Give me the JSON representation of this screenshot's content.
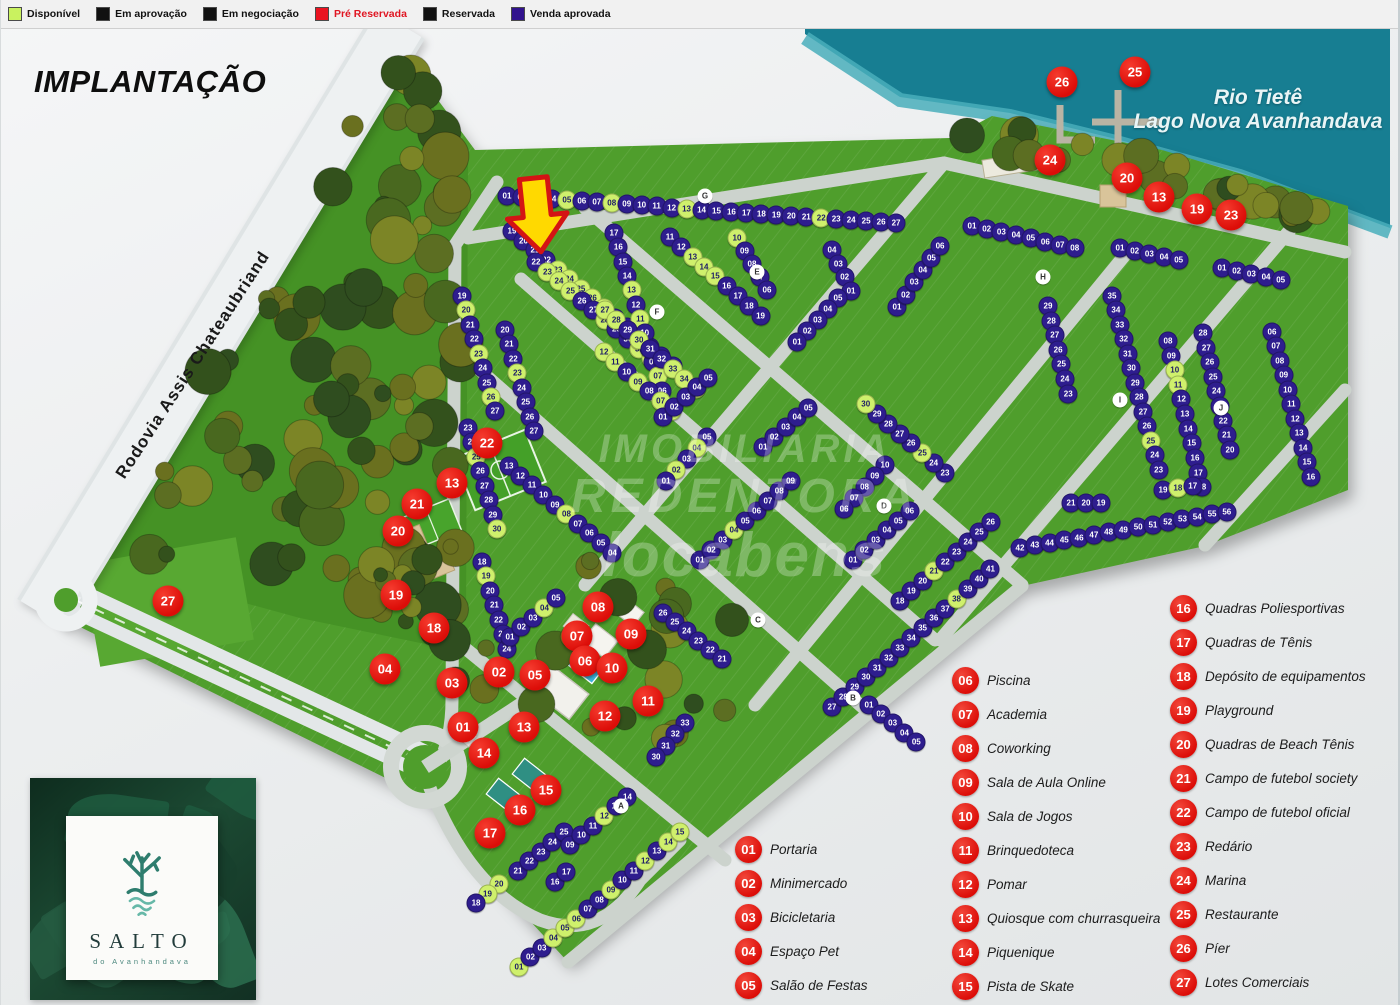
{
  "title": "IMPLANTAÇÃO",
  "road_label": "Rodovia Assis Chateaubriand",
  "water_label": {
    "line1": "Rio Tietê",
    "line2": "Lago Nova Avanhandava"
  },
  "watermark": {
    "line1": "IMOBILIARIA",
    "line2": "REDENTORA",
    "line3": "locabens"
  },
  "logo": {
    "name": "SALTO",
    "subtitle": "do Avanhandava"
  },
  "status_legend": [
    {
      "label": "Disponível",
      "color": "#c9f25f",
      "text": "#111111"
    },
    {
      "label": "Em aprovação",
      "color": "#111111",
      "text": "#111111"
    },
    {
      "label": "Em negociação",
      "color": "#111111",
      "text": "#111111"
    },
    {
      "label": "Pré Reservada",
      "color": "#ea1320",
      "text": "#e01622"
    },
    {
      "label": "Reservada",
      "color": "#111111",
      "text": "#111111"
    },
    {
      "label": "Venda aprovada",
      "color": "#31128d",
      "text": "#111111"
    }
  ],
  "lot_status_colors": {
    "p": {
      "bg": "#2e1d8e",
      "fg": "#ffffff"
    },
    "g": {
      "bg": "#cff06c",
      "fg": "#1d1b66"
    },
    "r": {
      "bg": "#e01313",
      "fg": "#ffffff"
    }
  },
  "amenities": {
    "col1": [
      {
        "num": "01",
        "label": "Portaria"
      },
      {
        "num": "02",
        "label": "Minimercado"
      },
      {
        "num": "03",
        "label": "Bicicletaria"
      },
      {
        "num": "04",
        "label": "Espaço Pet"
      },
      {
        "num": "05",
        "label": "Salão de Festas"
      }
    ],
    "col2": [
      {
        "num": "06",
        "label": "Piscina"
      },
      {
        "num": "07",
        "label": "Academia"
      },
      {
        "num": "08",
        "label": "Coworking"
      },
      {
        "num": "09",
        "label": "Sala de Aula Online"
      },
      {
        "num": "10",
        "label": "Sala de Jogos"
      },
      {
        "num": "11",
        "label": "Brinquedoteca"
      },
      {
        "num": "12",
        "label": "Pomar"
      },
      {
        "num": "13",
        "label": "Quiosque com churrasqueira"
      },
      {
        "num": "14",
        "label": "Piquenique"
      },
      {
        "num": "15",
        "label": "Pista de Skate"
      }
    ],
    "col3": [
      {
        "num": "16",
        "label": "Quadras Poliesportivas"
      },
      {
        "num": "17",
        "label": "Quadras de Tênis"
      },
      {
        "num": "18",
        "label": "Depósito de equipamentos"
      },
      {
        "num": "19",
        "label": "Playground"
      },
      {
        "num": "20",
        "label": "Quadras de Beach Tênis"
      },
      {
        "num": "21",
        "label": "Campo de futebol society"
      },
      {
        "num": "22",
        "label": "Campo de futebol oficial"
      },
      {
        "num": "23",
        "label": "Redário"
      },
      {
        "num": "24",
        "label": "Marina"
      },
      {
        "num": "25",
        "label": "Restaurante"
      },
      {
        "num": "26",
        "label": "Píer"
      },
      {
        "num": "27",
        "label": "Lotes Comerciais"
      }
    ]
  },
  "map_markers": [
    {
      "num": "26",
      "x": 1062,
      "y": 82
    },
    {
      "num": "25",
      "x": 1135,
      "y": 72
    },
    {
      "num": "24",
      "x": 1050,
      "y": 160
    },
    {
      "num": "20",
      "x": 1127,
      "y": 178
    },
    {
      "num": "13",
      "x": 1159,
      "y": 197
    },
    {
      "num": "19",
      "x": 1197,
      "y": 209
    },
    {
      "num": "23",
      "x": 1231,
      "y": 215
    },
    {
      "num": "22",
      "x": 487,
      "y": 443
    },
    {
      "num": "13",
      "x": 452,
      "y": 483
    },
    {
      "num": "21",
      "x": 417,
      "y": 504
    },
    {
      "num": "20",
      "x": 398,
      "y": 531
    },
    {
      "num": "19",
      "x": 396,
      "y": 595
    },
    {
      "num": "18",
      "x": 434,
      "y": 628
    },
    {
      "num": "27",
      "x": 168,
      "y": 601
    },
    {
      "num": "04",
      "x": 385,
      "y": 669
    },
    {
      "num": "03",
      "x": 452,
      "y": 683
    },
    {
      "num": "02",
      "x": 499,
      "y": 672
    },
    {
      "num": "01",
      "x": 463,
      "y": 727
    },
    {
      "num": "08",
      "x": 598,
      "y": 607
    },
    {
      "num": "07",
      "x": 577,
      "y": 636
    },
    {
      "num": "09",
      "x": 631,
      "y": 634
    },
    {
      "num": "06",
      "x": 585,
      "y": 661
    },
    {
      "num": "05",
      "x": 535,
      "y": 675
    },
    {
      "num": "10",
      "x": 612,
      "y": 668
    },
    {
      "num": "11",
      "x": 648,
      "y": 701
    },
    {
      "num": "12",
      "x": 605,
      "y": 716
    },
    {
      "num": "13",
      "x": 524,
      "y": 727
    },
    {
      "num": "14",
      "x": 484,
      "y": 753
    },
    {
      "num": "15",
      "x": 546,
      "y": 790
    },
    {
      "num": "16",
      "x": 520,
      "y": 810
    },
    {
      "num": "17",
      "x": 490,
      "y": 833
    }
  ],
  "block_letters": [
    {
      "l": "A",
      "x": 621,
      "y": 806
    },
    {
      "l": "B",
      "x": 853,
      "y": 698
    },
    {
      "l": "C",
      "x": 758,
      "y": 620
    },
    {
      "l": "D",
      "x": 884,
      "y": 506
    },
    {
      "l": "E",
      "x": 757,
      "y": 272
    },
    {
      "l": "F",
      "x": 657,
      "y": 312
    },
    {
      "l": "G",
      "x": 705,
      "y": 196
    },
    {
      "l": "H",
      "x": 1043,
      "y": 277
    },
    {
      "l": "I",
      "x": 1120,
      "y": 400
    },
    {
      "l": "J",
      "x": 1221,
      "y": 408
    }
  ],
  "lot_rows": [
    {
      "x": 507,
      "y": 196,
      "a": 4,
      "n": 27,
      "s": 1,
      "p": "ppgpgppgppppgppppppppgppppp"
    },
    {
      "x": 512,
      "y": 231,
      "a": 40,
      "n": 15,
      "s": 19,
      "p": "ppppgggggpppppp"
    },
    {
      "x": 462,
      "y": 296,
      "a": 74,
      "n": 9,
      "s": 19,
      "p": "pgppgppgp"
    },
    {
      "x": 536,
      "y": 262,
      "a": 40,
      "n": 12,
      "s": 22,
      "p": "pgggppgppggp"
    },
    {
      "x": 505,
      "y": 330,
      "a": 74,
      "n": 8,
      "s": 20,
      "p": "pppgpppp"
    },
    {
      "x": 614,
      "y": 233,
      "a": 73,
      "n": 12,
      "s": 17,
      "st": -1,
      "p": "ppppgpgpppgp"
    },
    {
      "x": 670,
      "y": 237,
      "a": 41,
      "n": 9,
      "s": 11,
      "p": "ppgggpppp"
    },
    {
      "x": 737,
      "y": 238,
      "a": 60,
      "n": 5,
      "s": 10,
      "st": -1,
      "p": "gpppp"
    },
    {
      "x": 605,
      "y": 310,
      "a": 41,
      "n": 9,
      "s": 27,
      "p": "ggpgppggg"
    },
    {
      "x": 604,
      "y": 352,
      "a": 41,
      "n": 7,
      "s": 12,
      "st": -1,
      "p": "ggpgpgg"
    },
    {
      "x": 663,
      "y": 417,
      "a": -41,
      "n": 5,
      "s": 1,
      "p": "ppppp"
    },
    {
      "x": 468,
      "y": 428,
      "a": 74,
      "n": 8,
      "s": 23,
      "p": "ppgppppg"
    },
    {
      "x": 509,
      "y": 466,
      "a": 40,
      "n": 10,
      "s": 13,
      "st": -1,
      "p": "pppppgpppp"
    },
    {
      "x": 482,
      "y": 562,
      "a": 74,
      "n": 7,
      "s": 18,
      "p": "pgppppp"
    },
    {
      "x": 510,
      "y": 637,
      "a": -40,
      "n": 5,
      "s": 1,
      "p": "pppgp"
    },
    {
      "x": 707,
      "y": 437,
      "a": 133,
      "n": 5,
      "s": 5,
      "st": -1,
      "p": "pgpgp"
    },
    {
      "x": 763,
      "y": 447,
      "a": -41,
      "n": 5,
      "s": 1,
      "p": "ppppp"
    },
    {
      "x": 832,
      "y": 250,
      "a": 65,
      "n": 4,
      "s": 4,
      "st": -1,
      "p": "pppp"
    },
    {
      "x": 838,
      "y": 298,
      "a": 133,
      "n": 5,
      "s": 5,
      "st": -1,
      "p": "ppppp"
    },
    {
      "x": 897,
      "y": 307,
      "a": -55,
      "n": 6,
      "s": 1,
      "p": "pppppp"
    },
    {
      "x": 945,
      "y": 473,
      "a": -139,
      "n": 8,
      "s": 23,
      "p": "ppgppppg"
    },
    {
      "x": 885,
      "y": 465,
      "a": 133,
      "n": 5,
      "s": 10,
      "st": -1,
      "p": "ppppp"
    },
    {
      "x": 853,
      "y": 560,
      "a": -41,
      "n": 6,
      "s": 1,
      "p": "pppppp"
    },
    {
      "x": 700,
      "y": 560,
      "a": -41,
      "n": 9,
      "s": 1,
      "p": "pppgppppp"
    },
    {
      "x": 972,
      "y": 226,
      "a": 12,
      "n": 8,
      "s": 1,
      "p": "pppppppp"
    },
    {
      "x": 1120,
      "y": 248,
      "a": 12,
      "n": 5,
      "s": 1,
      "p": "ppppp"
    },
    {
      "x": 1222,
      "y": 268,
      "a": 12,
      "n": 5,
      "s": 1,
      "p": "ppppp"
    },
    {
      "x": 1112,
      "y": 296,
      "a": 75,
      "n": 13,
      "s": 35,
      "st": -1,
      "p": "ppppppppppgpp"
    },
    {
      "x": 1071,
      "y": 503,
      "a": 0,
      "n": 3,
      "s": 21,
      "st": -1,
      "p": "ppp"
    },
    {
      "x": 1168,
      "y": 341,
      "a": 77,
      "n": 11,
      "s": 8,
      "p": "ppggppppppp"
    },
    {
      "x": 1163,
      "y": 490,
      "a": -8,
      "n": 3,
      "s": 19,
      "st": -1,
      "p": "pgp"
    },
    {
      "x": 1203,
      "y": 333,
      "a": 77,
      "n": 9,
      "s": 28,
      "st": -1,
      "p": "ppppppppp"
    },
    {
      "x": 1272,
      "y": 332,
      "a": 75,
      "n": 11,
      "s": 6,
      "p": "ppppppppppp"
    },
    {
      "x": 1048,
      "y": 306,
      "a": 77,
      "n": 7,
      "s": 29,
      "st": -1,
      "p": "ppppppp"
    },
    {
      "x": 832,
      "y": 707,
      "a": -41,
      "n": 15,
      "s": 27,
      "p": "pppppppppppgppp"
    },
    {
      "x": 1020,
      "y": 548,
      "a": -10,
      "n": 15,
      "s": 42,
      "p": "ppppppppppppppp"
    },
    {
      "x": 900,
      "y": 601,
      "a": -41,
      "n": 9,
      "s": 18,
      "p": "pppgppppp"
    },
    {
      "x": 663,
      "y": 613,
      "a": 38,
      "n": 6,
      "s": 26,
      "st": -1,
      "p": "pppppp"
    },
    {
      "x": 685,
      "y": 723,
      "a": 130,
      "n": 4,
      "s": 33,
      "st": -1,
      "p": "pppp"
    },
    {
      "x": 869,
      "y": 705,
      "a": 38,
      "n": 5,
      "s": 1,
      "p": "ppppp"
    },
    {
      "x": 519,
      "y": 967,
      "a": -40,
      "n": 15,
      "s": 1,
      "p": "gppgggppgppgpgg"
    },
    {
      "x": 499,
      "y": 884,
      "a": 140,
      "n": 3,
      "s": 20,
      "st": -1,
      "p": "ggp"
    },
    {
      "x": 518,
      "y": 871,
      "a": -40,
      "n": 5,
      "s": 21,
      "p": "ppppp"
    },
    {
      "x": 555,
      "y": 882,
      "a": -40,
      "n": 2,
      "s": 16,
      "p": "pp"
    },
    {
      "x": 570,
      "y": 845,
      "a": -40,
      "n": 6,
      "s": 9,
      "p": "pppgpp"
    }
  ]
}
